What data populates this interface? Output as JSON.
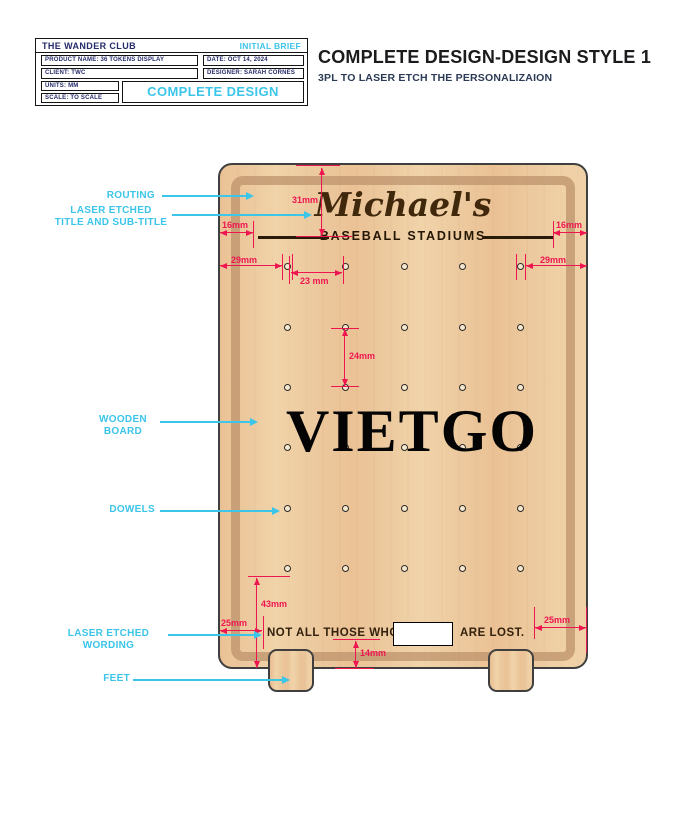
{
  "title_block": {
    "company": "THE WANDER CLUB",
    "status": "INITIAL BRIEF",
    "product": "PRODUCT NAME: 36 TOKENS DISPLAY",
    "date": "DATE: OCT 14, 2024",
    "client": "CLIENT: TWC",
    "designer": "DESIGNER: SARAH CORNES",
    "units": "UNITS: MM",
    "scale": "SCALE: TO SCALE",
    "stage_label": "COMPLETE DESIGN"
  },
  "header": {
    "title": "COMPLETE DESIGN-DESIGN STYLE 1",
    "subtitle": "3PL TO LASER ETCH THE PERSONALIZAION"
  },
  "board": {
    "title": "Michael's",
    "subtitle": "BASEBALL STADIUMS",
    "wording_left": "NOT ALL THOSE WHO",
    "wording_right": "ARE LOST.",
    "watermark": "VIETGO",
    "dowels": {
      "rows": 6,
      "columns": 5,
      "total": 30
    }
  },
  "dimensions": {
    "title_offset": "31mm",
    "etch_left": "16mm",
    "etch_right": "16mm",
    "dowel_left": "29mm",
    "dowel_right": "29mm",
    "spacing_h": "23 mm",
    "spacing_v": "24mm",
    "bottom_43": "43mm",
    "word_left_25": "25mm",
    "word_bottom_14": "14mm",
    "word_right_25": "25mm"
  },
  "callouts": {
    "routing": [
      "ROUTING"
    ],
    "etched_title": [
      "LASER ETCHED",
      "TITLE AND SUB-TITLE"
    ],
    "wooden_board": [
      "WOODEN",
      "BOARD"
    ],
    "dowels": [
      "DOWELS"
    ],
    "etched_wording": [
      "LASER ETCHED",
      "WORDING"
    ],
    "feet": [
      "FEET"
    ]
  },
  "colors": {
    "dimension_red": "#ee1650",
    "callout_cyan": "#3bc5e9",
    "navy": "#252a6a",
    "wood": "#ecc99e",
    "groove": "#c7a17b",
    "outline": "#3f3f3f",
    "etch_brown": "#2e1c08"
  }
}
